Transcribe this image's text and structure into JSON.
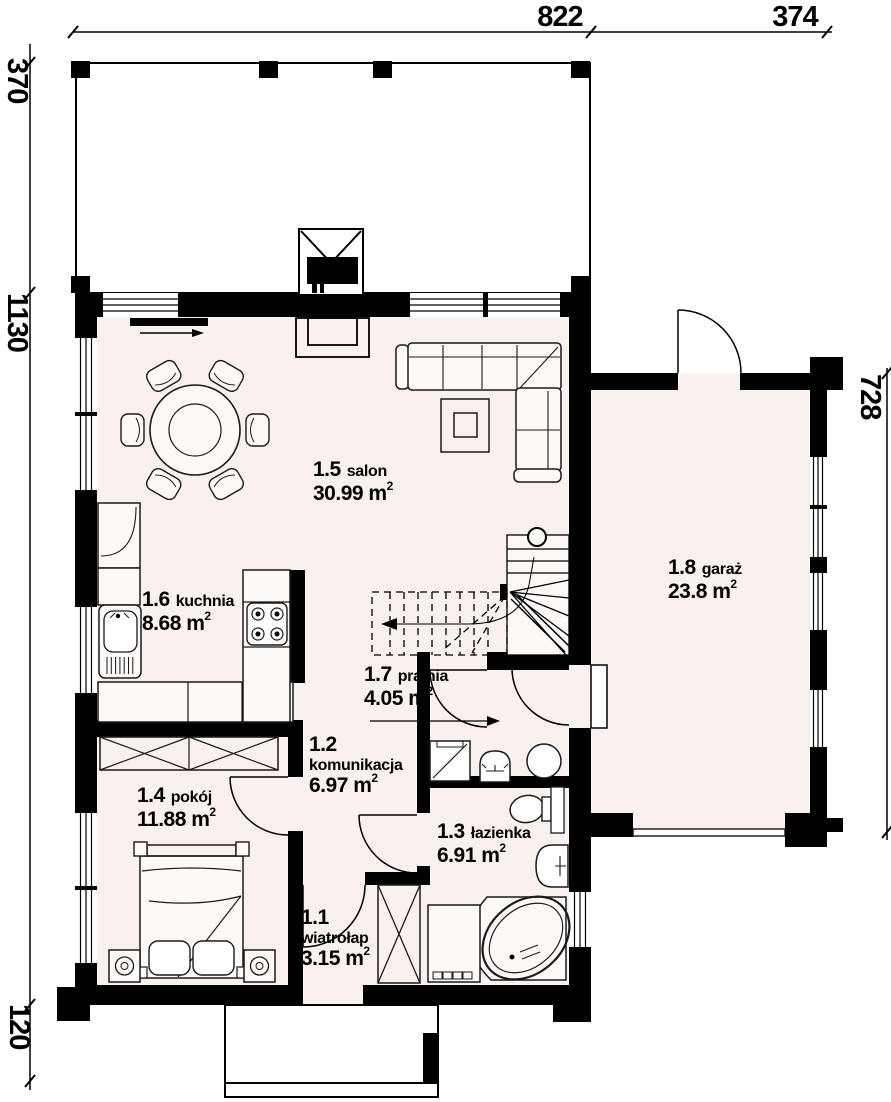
{
  "dimensions": {
    "top": [
      "822",
      "374"
    ],
    "left": [
      "370",
      "1130",
      "120"
    ],
    "right": [
      "728"
    ]
  },
  "rooms": [
    {
      "number": "1.5",
      "name": "salon",
      "area": "30.99 m",
      "sup": "2"
    },
    {
      "number": "1.6",
      "name": "kuchnia",
      "area": "8.68 m",
      "sup": "2"
    },
    {
      "number": "1.7",
      "name": "pralnia",
      "area": "4.05 m",
      "sup": "2"
    },
    {
      "number": "1.2",
      "name": "komunikacja",
      "area": "6.97 m",
      "sup": "2"
    },
    {
      "number": "1.4",
      "name": "pokój",
      "area": "11.88 m",
      "sup": "2"
    },
    {
      "number": "1.3",
      "name": "łazienka",
      "area": "6.91 m",
      "sup": "2"
    },
    {
      "number": "1.1",
      "name": "wiatrołap",
      "area": "3.15 m",
      "sup": "2"
    },
    {
      "number": "1.8",
      "name": "garaż",
      "area": "23.8 m",
      "sup": "2"
    }
  ],
  "colors": {
    "wall": "#000000",
    "floor": "#f8f1ed",
    "furniture": "#fdf9f7",
    "paper": "#ffffff"
  }
}
